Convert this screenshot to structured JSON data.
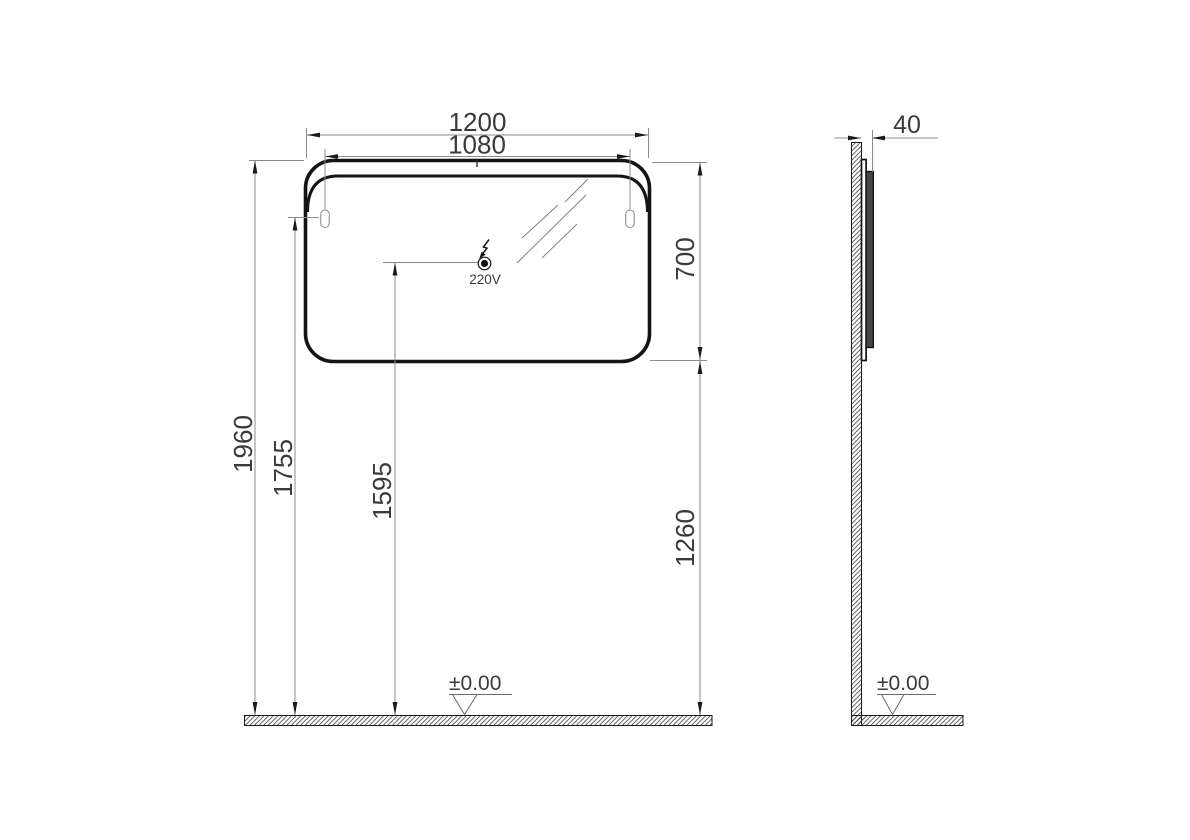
{
  "front_view": {
    "dim_width": "1200",
    "dim_hanger_spacing": "1080",
    "dim_mirror_height": "700",
    "dim_total_height": "1960",
    "dim_hanger_height": "1755",
    "dim_socket_height": "1595",
    "dim_bottom_height": "1260",
    "socket_voltage": "220V",
    "floor_level": "±0.00"
  },
  "side_view": {
    "dim_depth": "40",
    "floor_level": "±0.00"
  },
  "icons": {
    "power": "lightning-bolt-icon",
    "floor_level_front": "datum-level-icon",
    "floor_level_side": "datum-level-icon"
  },
  "colors": {
    "background": "#ffffff",
    "outline": "#141414",
    "dimension_lines": "#8c8c8c",
    "text": "#3a3a3a",
    "side_panel_fill": "#464646"
  }
}
